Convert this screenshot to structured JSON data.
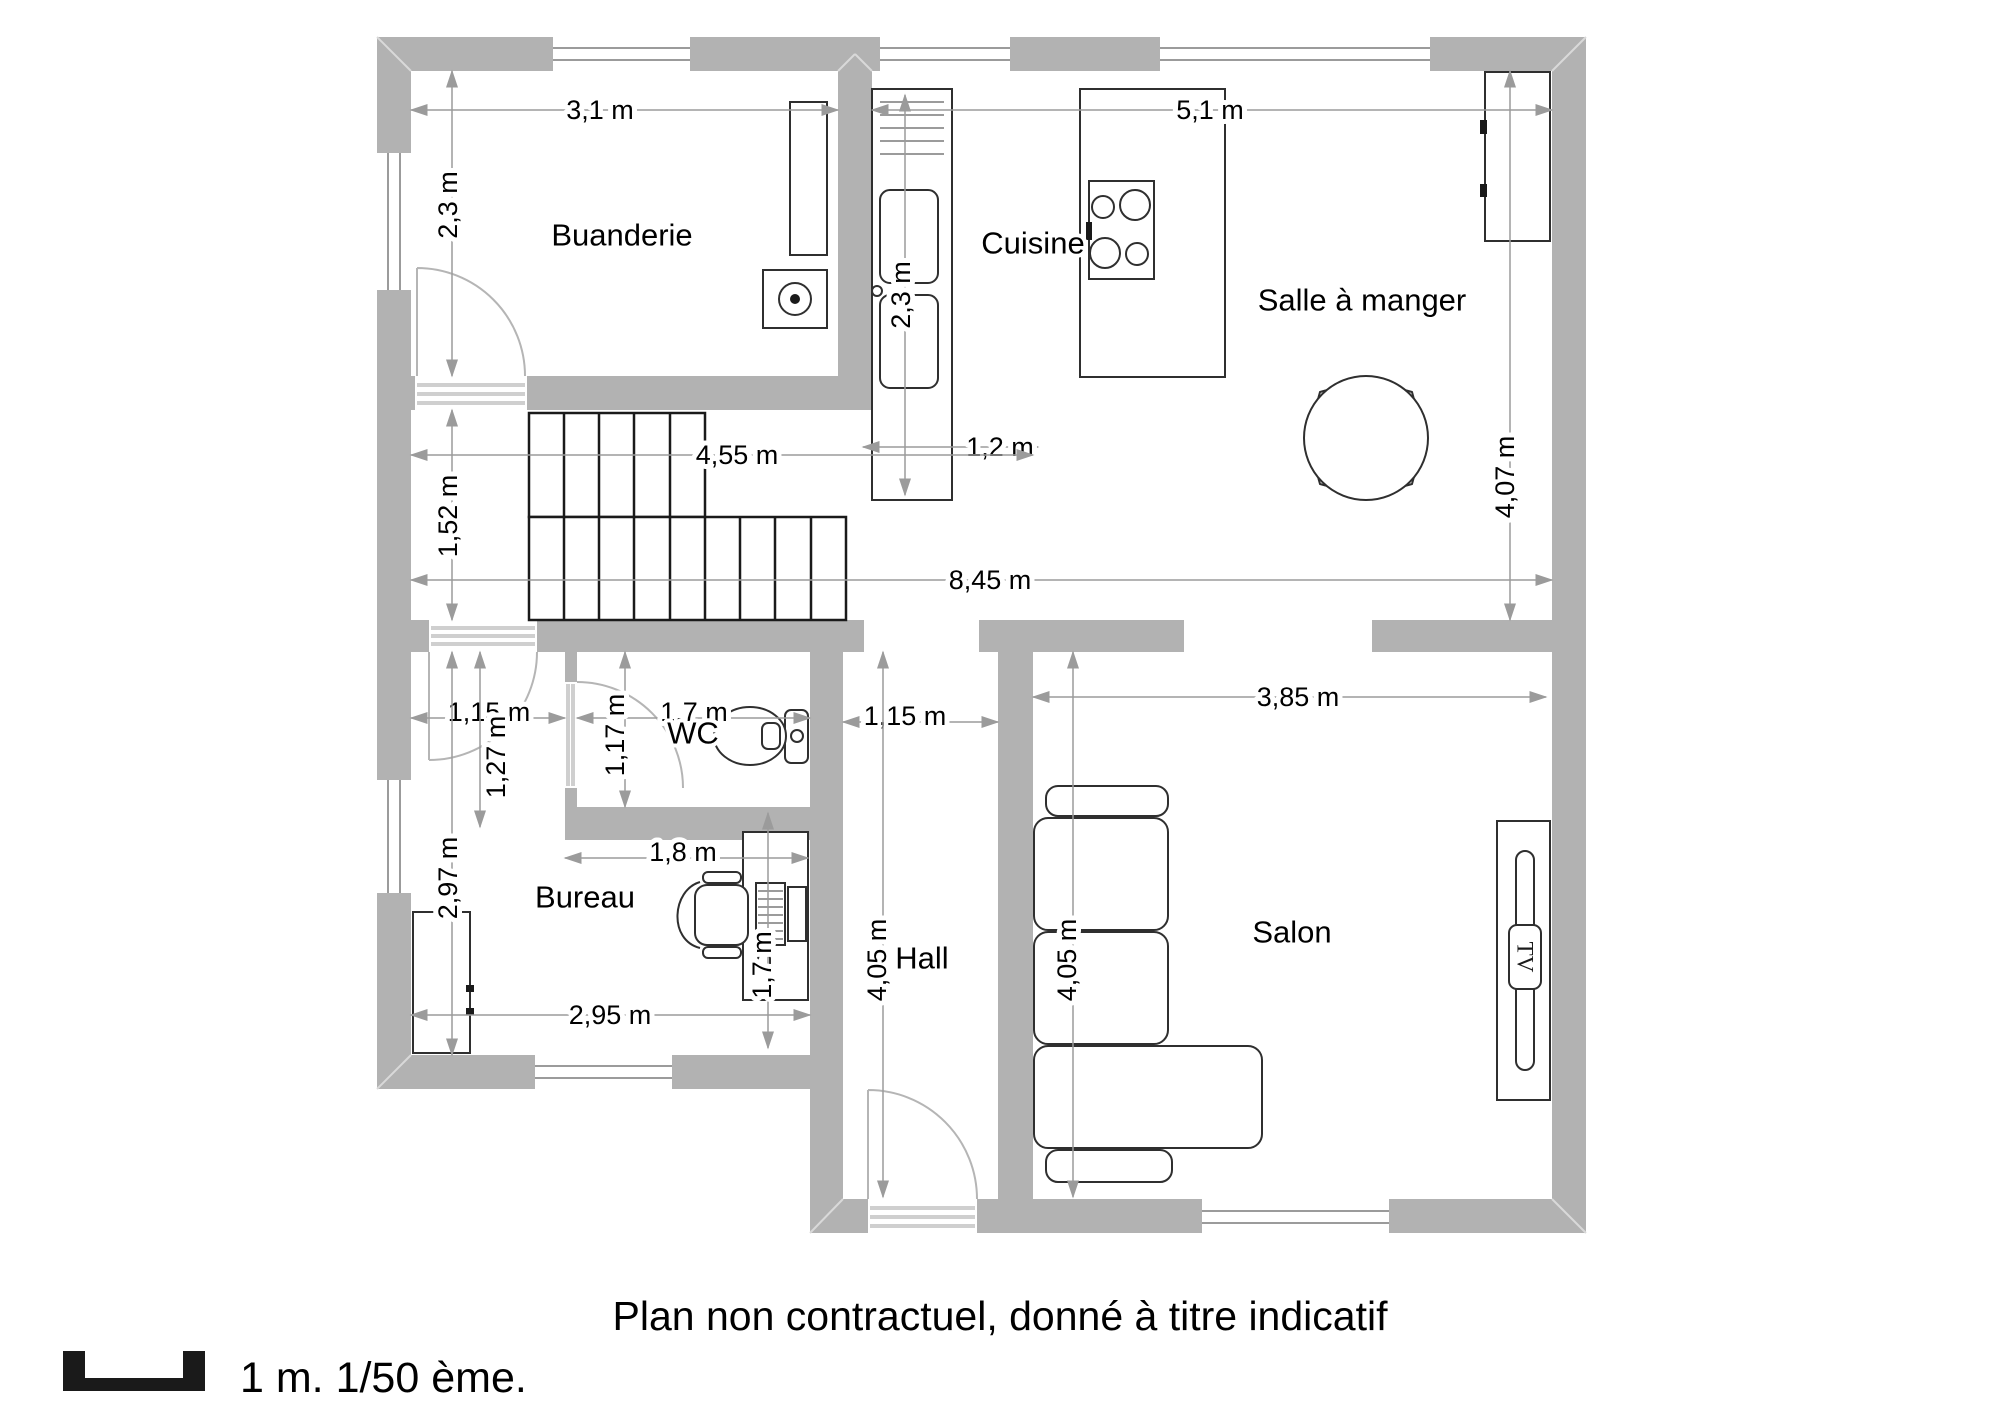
{
  "plan": {
    "caption": "Plan non contractuel, donné à titre indicatif",
    "scale_label": "1 m. 1/50 ème."
  },
  "rooms": {
    "buanderie": {
      "name": "Buanderie",
      "width": "3,1 m",
      "depth": "2,3 m"
    },
    "cuisine": {
      "name": "Cuisine",
      "width": "5,1 m"
    },
    "salle_a_manger": {
      "name": "Salle à manger",
      "depth": "4,07 m"
    },
    "wc": {
      "name": "WC",
      "width": "1,7 m",
      "depth": "1,17 m"
    },
    "bureau": {
      "name": "Bureau",
      "width": "2,95 m",
      "depth": "2,97 m"
    },
    "hall": {
      "name": "Hall",
      "width": "1,15 m",
      "depth": "4,05 m"
    },
    "salon": {
      "name": "Salon",
      "width": "3,85 m",
      "depth": "4,05 m"
    }
  },
  "dims": {
    "counter_length": "2,3 m",
    "counter_width": "1,2 m",
    "stair_width": "4,55 m",
    "stair_strip_depth": "1,52 m",
    "total_width": "8,45 m",
    "lobby_width": "1,15 m",
    "lobby_depth": "1,27 m",
    "desk_width": "1,8 m",
    "desk_length": "1,7 m"
  },
  "furniture": {
    "tv_label": "TV"
  }
}
